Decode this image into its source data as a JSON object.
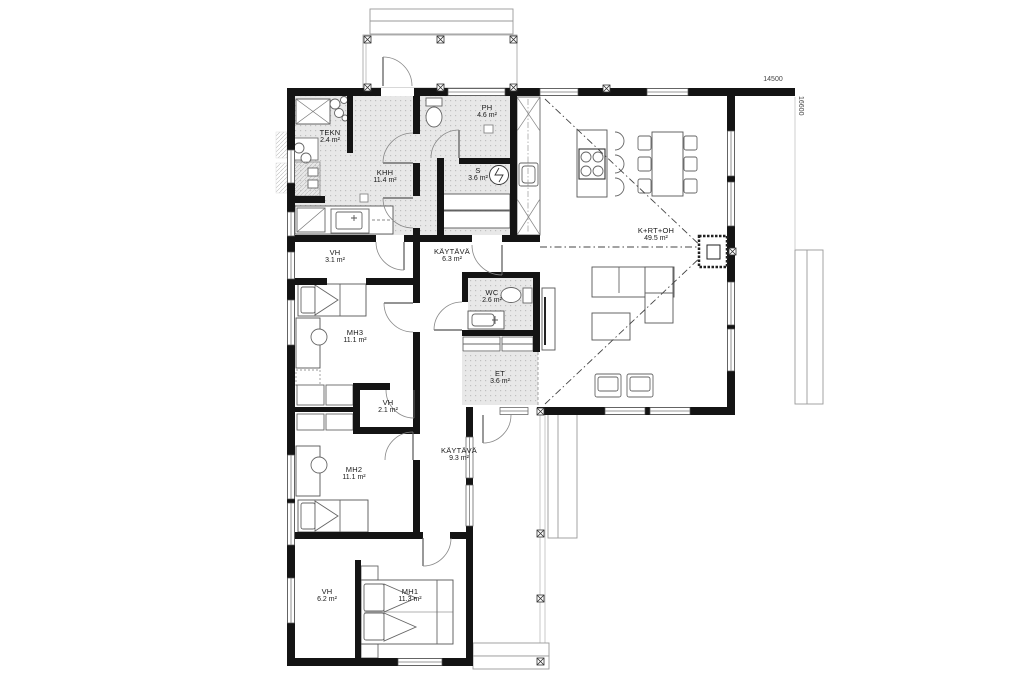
{
  "dimensions": {
    "width_label": "14500",
    "height_label": "16600"
  },
  "colors": {
    "wall": "#141414",
    "tile_floor": "#e8e8e8",
    "tile_dot": "#bfbfbf",
    "furniture_outline": "#666666",
    "dimension_text": "#444444"
  },
  "rooms": [
    {
      "id": "tekn",
      "name": "TEKN",
      "area": "2.4 m²"
    },
    {
      "id": "khh",
      "name": "KHH",
      "area": "11.4 m²"
    },
    {
      "id": "ph",
      "name": "PH",
      "area": "4.6 m²"
    },
    {
      "id": "s",
      "name": "S",
      "area": "3.6 m²"
    },
    {
      "id": "krtoh",
      "name": "K+RT+OH",
      "area": "49.5 m²"
    },
    {
      "id": "kaytava1",
      "name": "KÄYTÄVÄ",
      "area": "6.3 m²"
    },
    {
      "id": "vh1",
      "name": "VH",
      "area": "3.1 m²"
    },
    {
      "id": "wc",
      "name": "WC",
      "area": "2.6 m²"
    },
    {
      "id": "mh3",
      "name": "MH3",
      "area": "11.1 m²"
    },
    {
      "id": "et",
      "name": "ET",
      "area": "3.6 m²"
    },
    {
      "id": "vh2",
      "name": "VH",
      "area": "2.1 m²"
    },
    {
      "id": "kaytava2",
      "name": "KÄYTÄVÄ",
      "area": "9.3 m²"
    },
    {
      "id": "mh2",
      "name": "MH2",
      "area": "11.1 m²"
    },
    {
      "id": "vh3",
      "name": "VH",
      "area": "6.2 m²"
    },
    {
      "id": "mh1",
      "name": "MH1",
      "area": "11.3 m²"
    }
  ]
}
